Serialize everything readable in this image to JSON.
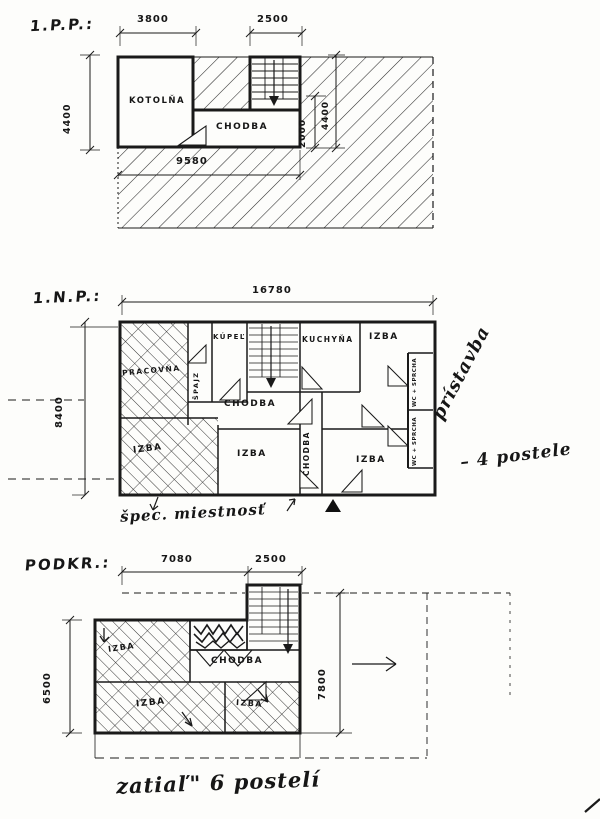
{
  "palette": {
    "paper": "#fdfdfb",
    "ink": "#1a1a1a"
  },
  "plans": {
    "basement": {
      "title": "1.P.P.:",
      "dims": {
        "top_left": "3800",
        "top_right": "2500",
        "left": "4400",
        "inner_small": "2000",
        "inner_large": "4400",
        "bottom": "9580"
      },
      "rooms": {
        "kotolna": "KOTOLŇA",
        "chodba": "CHODBA"
      }
    },
    "ground": {
      "title": "1.N.P.:",
      "dims": {
        "top": "16780",
        "left": "8400"
      },
      "rooms": {
        "pracovna": "PRACOVŇA",
        "spajz": "ŠPAJZ",
        "kupel": "KÚPEĽ",
        "kuchyna": "KUCHYŇA",
        "izba_top": "IZBA",
        "wc_top": "WC + SPRCHA",
        "wc_bottom": "WC + SPRCHA",
        "chodba": "CHODBA",
        "chodba_vert": "CHODBA",
        "izba_left": "IZBA",
        "izba_mid": "IZBA",
        "izba_right": "IZBA"
      },
      "annotations": {
        "pristavba": "prístavba",
        "beds": "– 4 postele",
        "spec": "špec. miestnosť"
      }
    },
    "attic": {
      "title": "PODKR.:",
      "dims": {
        "top_left": "7080",
        "top_right": "2500",
        "left": "6500",
        "right": "7800"
      },
      "rooms": {
        "izba_tl": "IZBA",
        "chodba": "CHODBA",
        "izba_bl": "IZBA",
        "izba_br": "IZBA"
      },
      "annotations": {
        "beds": "zatiaľ\" 6 postelí"
      }
    }
  }
}
